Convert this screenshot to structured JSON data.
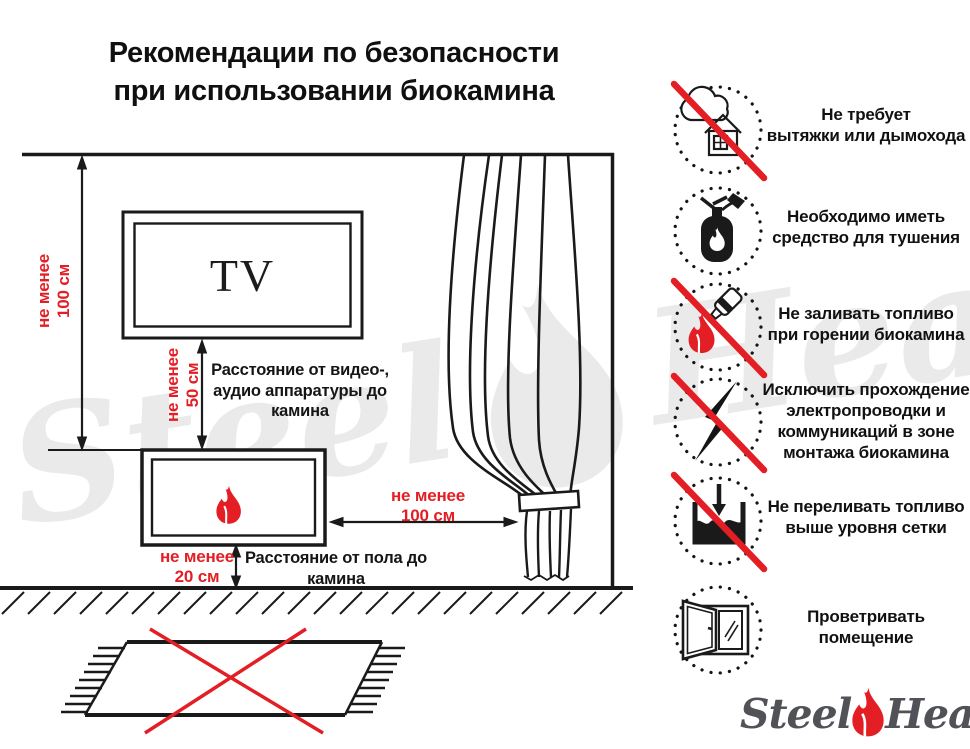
{
  "title": {
    "line1": "Рекомендации по безопасности",
    "line2": "при использовании биокамина"
  },
  "diagram": {
    "tv_label": "TV",
    "dim_tv_wall": "не менее\n100 см",
    "dim_tv_fireplace": "не менее\n50 см",
    "note_av_distance": "Расстояние от видео-,\nаудио аппаратуры до\nкамина",
    "dim_fireplace_curtain": "не менее\n100 см",
    "dim_fireplace_floor": "не менее\n20 см",
    "note_floor_distance": "Расстояние от пола до\nкамина"
  },
  "rules": [
    {
      "icon": "no-chimney",
      "label": "Не требует\nвытяжки или дымохода"
    },
    {
      "icon": "extinguisher-required",
      "label": "Необходимо иметь\nсредство для тушения"
    },
    {
      "icon": "no-refill-while-burning",
      "label": "Не заливать топливо\nпри горении биокамина"
    },
    {
      "icon": "no-wiring-in-zone",
      "label": "Исключить прохождение\nэлектропроводки и\nкоммуникаций в зоне\nмонтажа биокамина"
    },
    {
      "icon": "no-overfill",
      "label": "Не переливать топливо\nвыше уровня сетки"
    },
    {
      "icon": "ventilate-room",
      "label": "Проветривать\nпомещение"
    }
  ],
  "logo": {
    "steel": "Steel",
    "heat": "Heat"
  },
  "watermark": {
    "steel": "Steel",
    "heat": "Heat"
  },
  "colors": {
    "accent_red": "#e31e24",
    "line_black": "#1a1a1a",
    "watermark_gray": "#eaeaea",
    "logo_gray": "#515257"
  }
}
